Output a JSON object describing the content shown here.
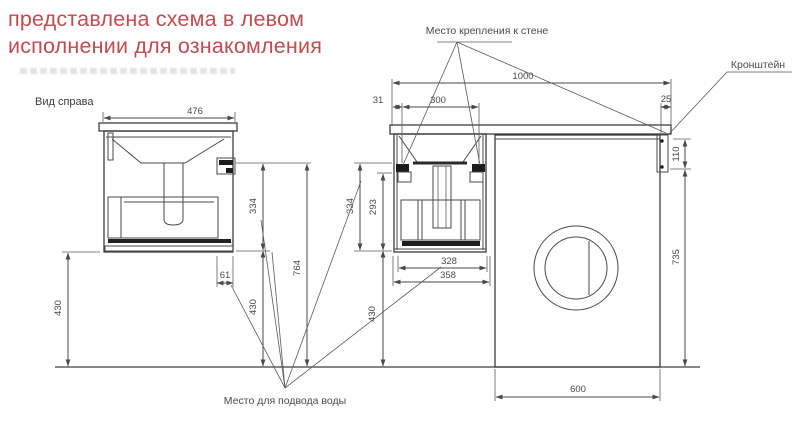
{
  "note": {
    "line1": "представлена схема в левом",
    "line2": "исполнении для ознакомления"
  },
  "labels": {
    "view_right": "Вид справа",
    "wall_mount": "Место крепления к стене",
    "bracket": "Кронштейн",
    "water_supply": "Место для подвода воды"
  },
  "dims": {
    "d476": "476",
    "d430_left": "430",
    "d61": "61",
    "d334_side": "334",
    "d430_side": "430",
    "d764": "764",
    "d31": "31",
    "d300": "300",
    "d1000": "1000",
    "d25": "25",
    "d334_front": "334",
    "d293": "293",
    "d328": "328",
    "d358": "358",
    "d430_front": "430",
    "d110": "110",
    "d735": "735",
    "d600": "600"
  },
  "colors": {
    "note_red": "#c64a4e",
    "line_gray": "#4a4a4a",
    "fill_black": "#1c1c1c",
    "background": "#ffffff"
  }
}
